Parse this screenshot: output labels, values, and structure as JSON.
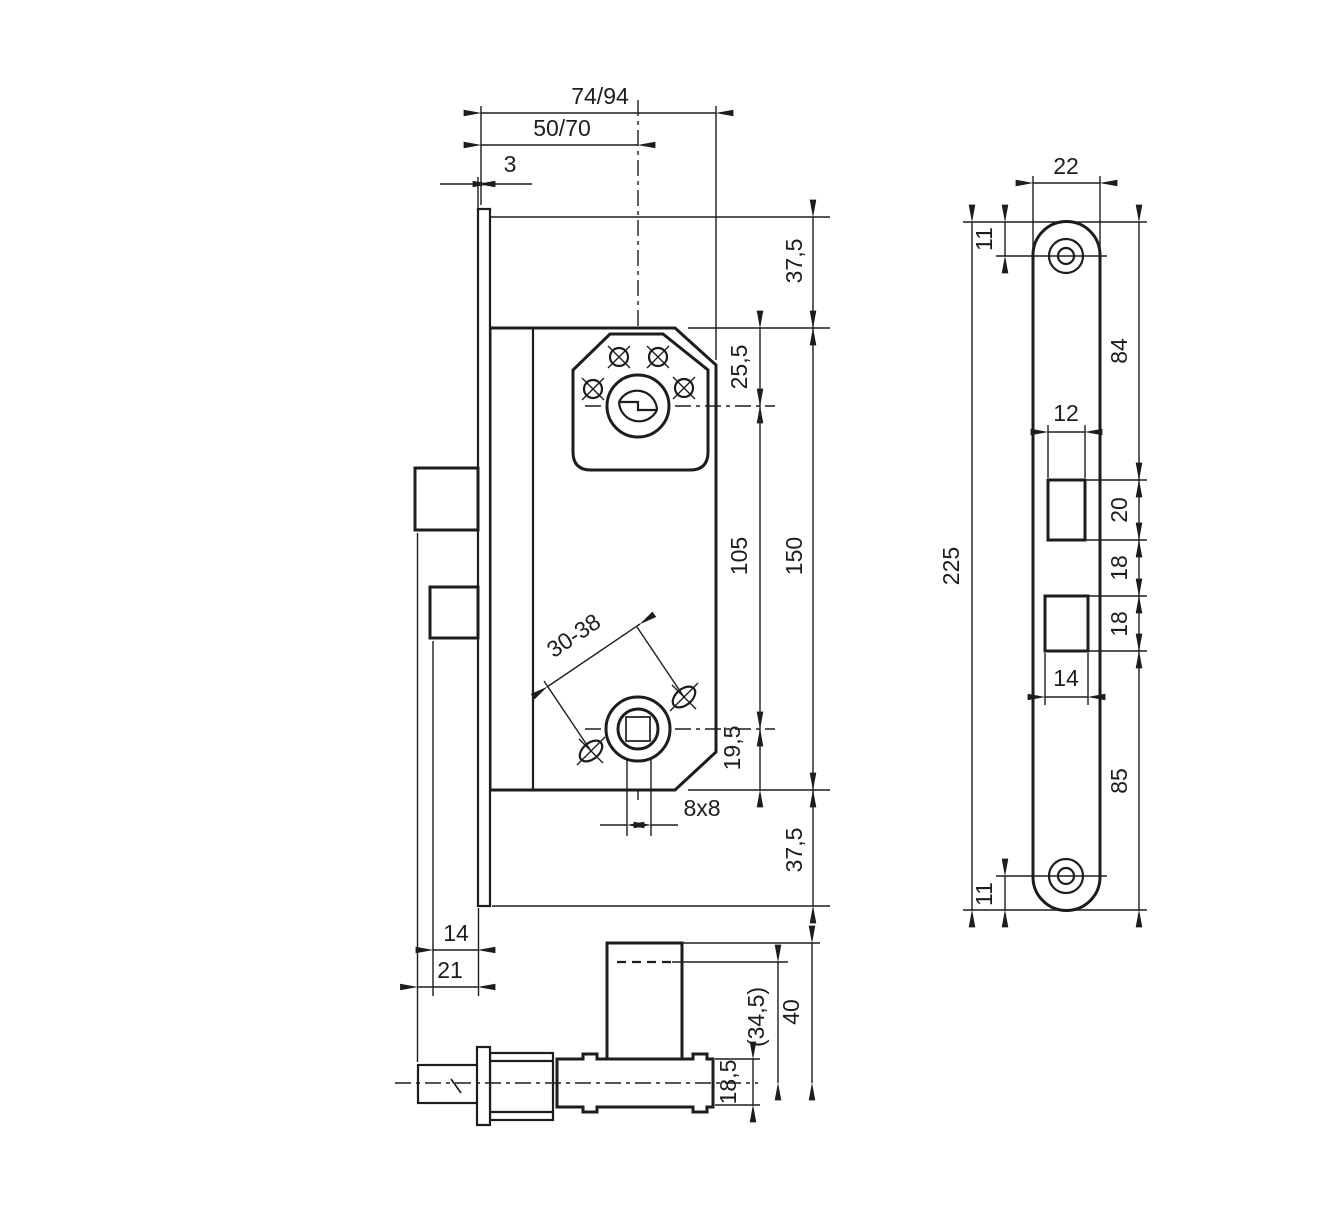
{
  "colors": {
    "ink": "#1d1d1d",
    "paper": "#ffffff"
  },
  "main_view": {
    "labels": {
      "case_depth": "74/94",
      "backset": "50/70",
      "faceplate_thickness": "3",
      "top_margin": "37,5",
      "case_top_to_cylinder": "25,5",
      "cylinder_to_spindle": "105",
      "case_height": "150",
      "spindle_to_case_bottom": "19,5",
      "bottom_margin": "37,5",
      "spindle_square": "8x8",
      "handle_screw_spacing": "30-38",
      "deadbolt_protrusion": "14",
      "latch_protrusion": "21"
    }
  },
  "faceplate_view": {
    "labels": {
      "plate_width": "22",
      "top_screw_offset": "11",
      "plate_height": "225",
      "top_to_latch_opening": "84",
      "latch_opening_width": "12",
      "latch_opening_height": "20",
      "openings_gap": "18",
      "deadbolt_opening_height": "18",
      "deadbolt_opening_width": "14",
      "deadbolt_opening_to_bottom": "85",
      "bottom_screw_offset": "11"
    }
  },
  "bottom_view": {
    "labels": {
      "cylinder_protrusion": "40",
      "cylinder_cut_length": "(34,5)",
      "case_thickness": "18,5"
    }
  }
}
